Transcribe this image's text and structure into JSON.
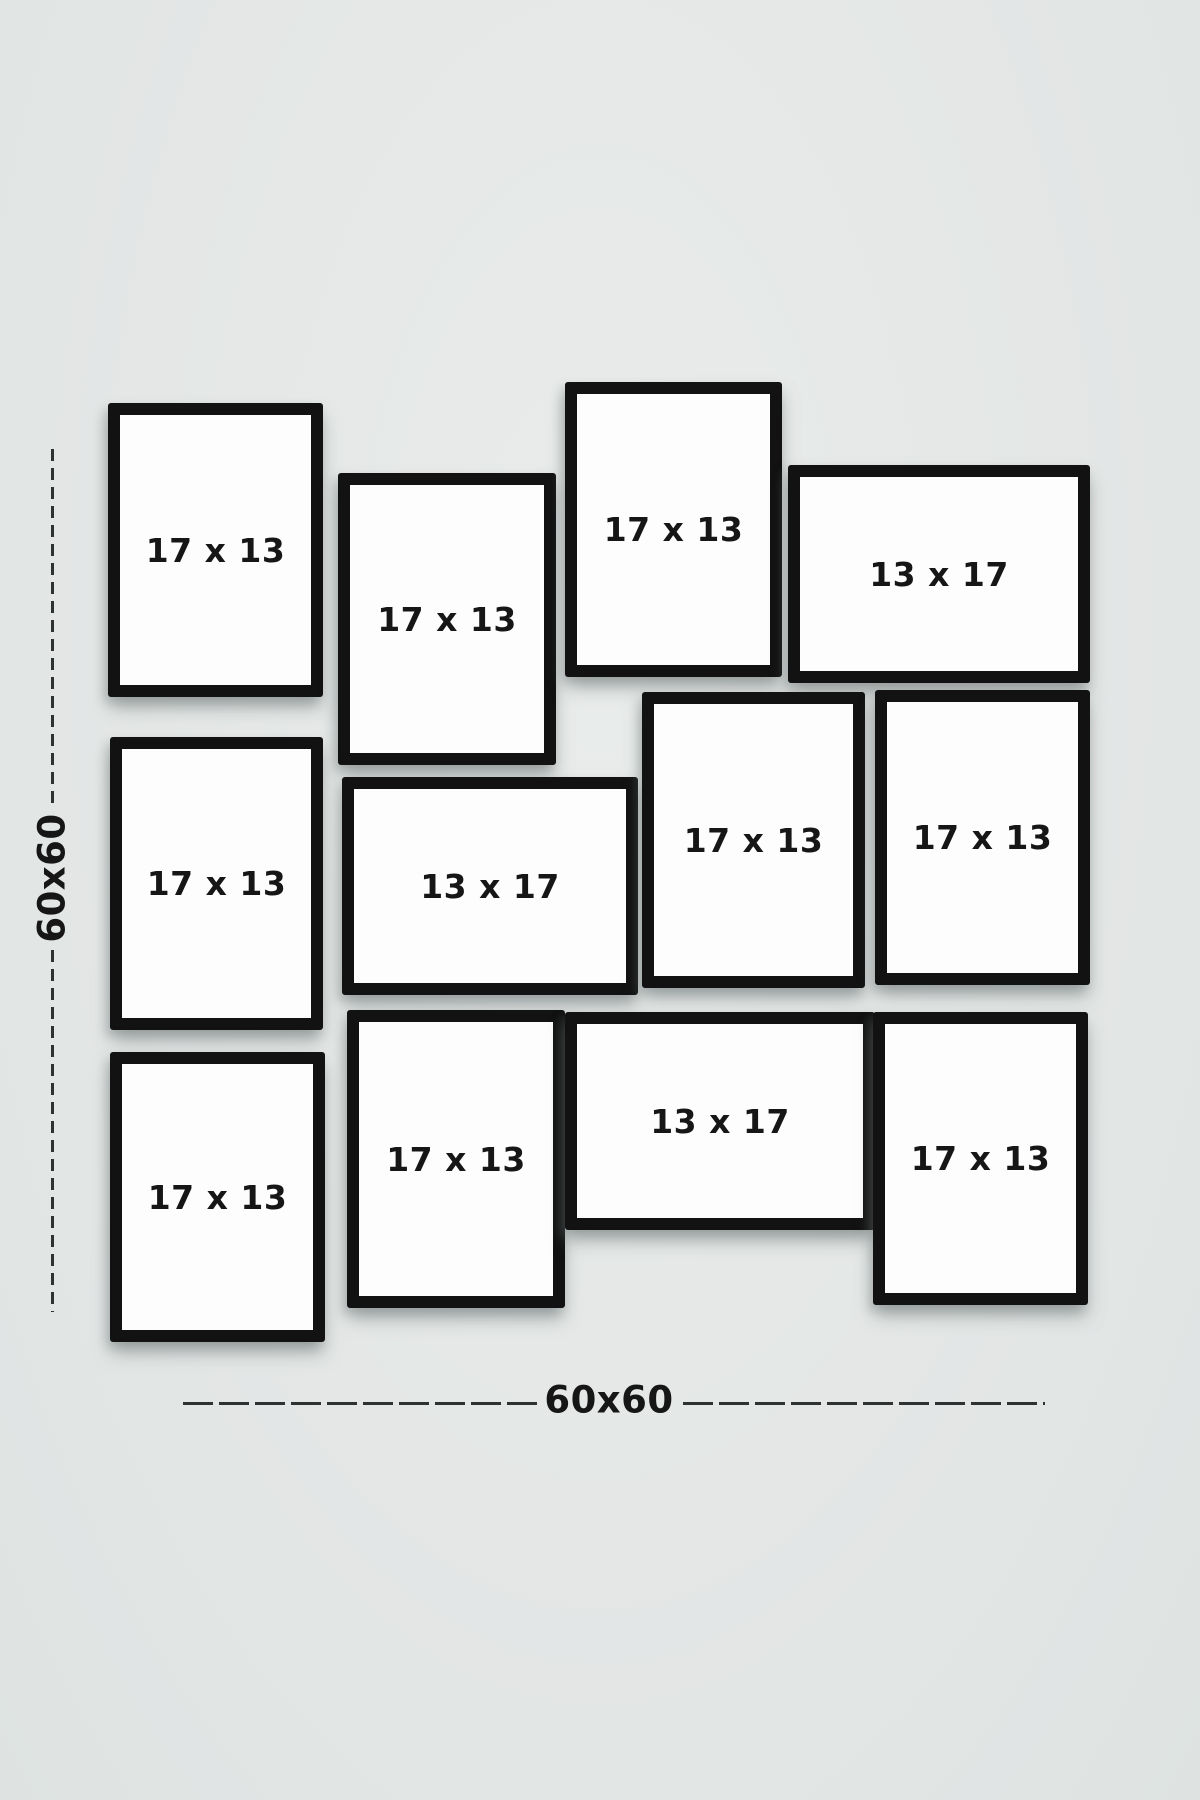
{
  "page": {
    "background": "#e4e7e6"
  },
  "colors": {
    "frame_border": "#121212",
    "frame_fill": "#fdfdfd",
    "dash_line": "#2f3232",
    "label_text": "#161616"
  },
  "dimensions": {
    "vertical": {
      "label": "60x60"
    },
    "horizontal": {
      "label": "60x60"
    }
  },
  "frames": [
    {
      "id": "frame-1",
      "label": "17 x 13",
      "orientation": "portrait",
      "x": 108,
      "y": 403,
      "w": 215,
      "h": 294
    },
    {
      "id": "frame-2",
      "label": "17 x 13",
      "orientation": "portrait",
      "x": 338,
      "y": 473,
      "w": 218,
      "h": 292
    },
    {
      "id": "frame-3",
      "label": "17 x 13",
      "orientation": "portrait",
      "x": 565,
      "y": 382,
      "w": 217,
      "h": 295
    },
    {
      "id": "frame-4",
      "label": "13 x 17",
      "orientation": "landscape",
      "x": 788,
      "y": 465,
      "w": 302,
      "h": 218
    },
    {
      "id": "frame-5",
      "label": "17 x 13",
      "orientation": "portrait",
      "x": 110,
      "y": 737,
      "w": 213,
      "h": 293
    },
    {
      "id": "frame-6",
      "label": "13 x 17",
      "orientation": "landscape",
      "x": 342,
      "y": 777,
      "w": 296,
      "h": 218
    },
    {
      "id": "frame-7",
      "label": "17 x 13",
      "orientation": "portrait",
      "x": 642,
      "y": 692,
      "w": 223,
      "h": 296
    },
    {
      "id": "frame-8",
      "label": "17 x 13",
      "orientation": "portrait",
      "x": 875,
      "y": 690,
      "w": 215,
      "h": 295
    },
    {
      "id": "frame-9",
      "label": "17 x 13",
      "orientation": "portrait",
      "x": 110,
      "y": 1052,
      "w": 215,
      "h": 290
    },
    {
      "id": "frame-10",
      "label": "17 x 13",
      "orientation": "portrait",
      "x": 347,
      "y": 1010,
      "w": 218,
      "h": 298
    },
    {
      "id": "frame-11",
      "label": "13 x 17",
      "orientation": "landscape",
      "x": 565,
      "y": 1012,
      "w": 310,
      "h": 218
    },
    {
      "id": "frame-12",
      "label": "17 x 13",
      "orientation": "portrait",
      "x": 873,
      "y": 1012,
      "w": 215,
      "h": 293
    }
  ]
}
